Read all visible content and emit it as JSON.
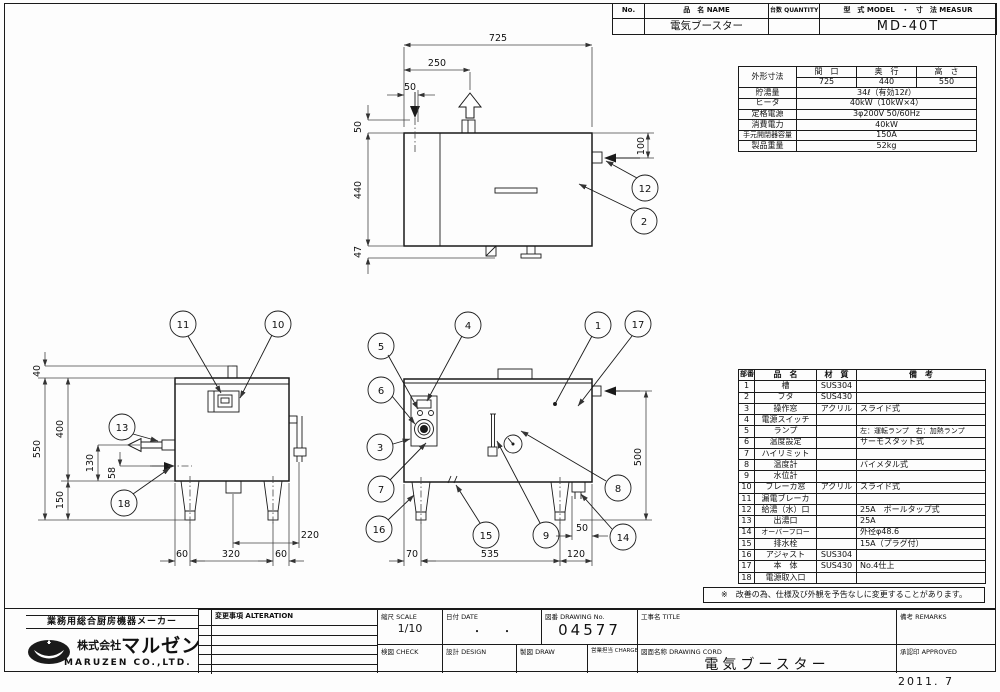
{
  "header_table": {
    "no_label": "No.",
    "name_label": "品　名 NAME",
    "qty_label": "台数 QUANTITY",
    "model_label": "型　式 MODEL　・　寸　法 MEASUR",
    "name_value": "電気ブースター",
    "model_value": "MD-40T"
  },
  "spec": {
    "dim_label": "外形寸法",
    "w_label": "間　口",
    "d_label": "奥　行",
    "h_label": "高　さ",
    "w": "725",
    "d": "440",
    "h": "550",
    "rows": [
      {
        "label": "貯湯量",
        "value": "34ℓ（有効12ℓ）"
      },
      {
        "label": "ヒータ",
        "value": "40kW（10kW×4）"
      },
      {
        "label": "定格電源",
        "value": "3φ200V 50/60Hz"
      },
      {
        "label": "消費電力",
        "value": "40kW"
      },
      {
        "label": "手元開閉器容量",
        "value": "150A"
      },
      {
        "label": "製品重量",
        "value": "52kg"
      }
    ]
  },
  "parts": {
    "col_num": "部番",
    "col_name": "品　名",
    "col_material": "材　質",
    "col_note": "備　考",
    "rows": [
      {
        "num": "1",
        "name": "槽",
        "material": "SUS304",
        "note": ""
      },
      {
        "num": "2",
        "name": "フタ",
        "material": "SUS430",
        "note": ""
      },
      {
        "num": "3",
        "name": "操作窓",
        "material": "アクリル",
        "note": "スライド式"
      },
      {
        "num": "4",
        "name": "電源スイッチ",
        "material": "",
        "note": ""
      },
      {
        "num": "5",
        "name": "ランプ",
        "material": "",
        "note": "左：運転ランプ　右：加熱ランプ"
      },
      {
        "num": "6",
        "name": "温度設定",
        "material": "",
        "note": "サーモスタット式"
      },
      {
        "num": "7",
        "name": "ハイリミット",
        "material": "",
        "note": ""
      },
      {
        "num": "8",
        "name": "温度計",
        "material": "",
        "note": "バイメタル式"
      },
      {
        "num": "9",
        "name": "水位計",
        "material": "",
        "note": ""
      },
      {
        "num": "10",
        "name": "ブレーカ窓",
        "material": "アクリル",
        "note": "スライド式"
      },
      {
        "num": "11",
        "name": "漏電ブレーカ",
        "material": "",
        "note": ""
      },
      {
        "num": "12",
        "name": "給湯（水）口",
        "material": "",
        "note": "25A　ボールタップ式"
      },
      {
        "num": "13",
        "name": "出湯口",
        "material": "",
        "note": "25A"
      },
      {
        "num": "14",
        "name": "オーバーフロー",
        "material": "",
        "note": "外径φ48.6"
      },
      {
        "num": "15",
        "name": "排水栓",
        "material": "",
        "note": "15A（プラグ付）"
      },
      {
        "num": "16",
        "name": "アジャスト",
        "material": "SUS304",
        "note": ""
      },
      {
        "num": "17",
        "name": "本　体",
        "material": "SUS430",
        "note": "No.4仕上"
      },
      {
        "num": "18",
        "name": "電源取入口",
        "material": "",
        "note": ""
      }
    ]
  },
  "note": {
    "text": "※　改善の為、仕様及び外観を予告なしに変更することがあります。"
  },
  "tb": {
    "tagline": "業務用総合厨房機器メーカー",
    "company_prefix": "株式会社",
    "company": "マルゼン",
    "company_en": "MARUZEN  CO.,LTD.",
    "alteration": "変更事項 ALTERATION",
    "scale_l": "縮尺 SCALE",
    "scale_v": "1/10",
    "date_l": "日付 DATE",
    "date_v": "・　　・",
    "no_l": "図番 DRAWING  No.",
    "no_v": "04577",
    "title_l": "工事名 TITLE",
    "title_v": "",
    "check_l": "検図 CHECK",
    "design_l": "設計 DESIGN",
    "draw_l": "製図 DRAW",
    "charge_l": "営業担当 CHARGE",
    "name_l": "図面名称 DRAWING  CORD",
    "name_v": "電気ブースター",
    "remarks_l": "備考 REMARKS",
    "approved_l": "承認印 APPROVED",
    "stamp": "2011. 7"
  },
  "dims": {
    "top": {
      "w": "725",
      "lid": "250",
      "ix": "50",
      "tg": "50",
      "d": "440",
      "dr": "47",
      "iy": "100"
    },
    "side": {
      "stub": "40",
      "total": "550",
      "body": "400",
      "outlet": "130",
      "pw": "58",
      "leg": "150",
      "a": "60",
      "b": "320",
      "c": "60",
      "pipe": "220"
    },
    "front": {
      "h": "500",
      "ov": "50",
      "a": "70",
      "b": "535",
      "c": "120"
    }
  },
  "callouts": {
    "c1": "1",
    "c2": "2",
    "c3": "3",
    "c4": "4",
    "c5": "5",
    "c6": "6",
    "c7": "7",
    "c8": "8",
    "c9": "9",
    "c10": "10",
    "c11": "11",
    "c12": "12",
    "c13": "13",
    "c14": "14",
    "c15": "15",
    "c16": "16",
    "c17": "17",
    "c18": "18"
  }
}
